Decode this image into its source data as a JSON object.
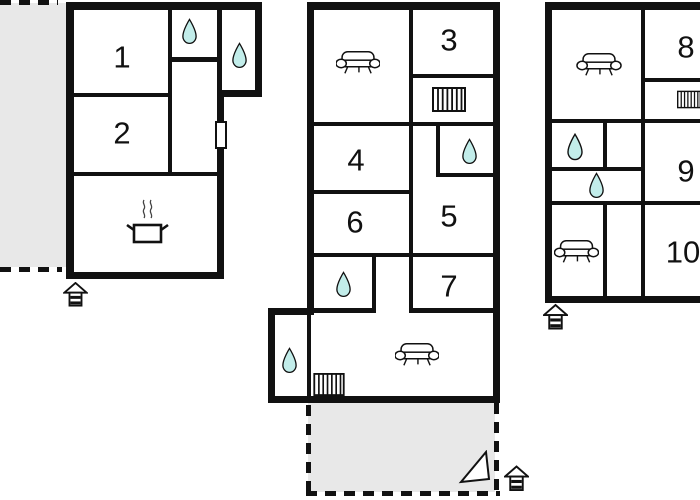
{
  "colors": {
    "wall": "#111111",
    "water_fill": "#c2edea",
    "terrace_fill": "#e8e8e8",
    "background": "#ffffff",
    "icon_stroke": "#111111"
  },
  "buildings": [
    {
      "id": "house-left",
      "rooms": [
        {
          "number": "1",
          "cx": 122,
          "cy": 57
        },
        {
          "number": "2",
          "cx": 122,
          "cy": 133
        }
      ],
      "icons": [
        {
          "name": "water-drop-icon",
          "x": 181,
          "y": 18,
          "w": 17,
          "h": 27
        },
        {
          "name": "water-drop-icon",
          "x": 231,
          "y": 42,
          "w": 17,
          "h": 27
        },
        {
          "name": "kitchen-stove-icon",
          "x": 124,
          "y": 197,
          "w": 46,
          "h": 50
        },
        {
          "name": "door-marker",
          "x": 215,
          "y": 121,
          "w": 12,
          "h": 28
        },
        {
          "name": "entrance-arrow-icon",
          "x": 63,
          "y": 282,
          "w": 25,
          "h": 25
        }
      ]
    },
    {
      "id": "house-middle",
      "rooms": [
        {
          "number": "3",
          "cx": 449,
          "cy": 40
        },
        {
          "number": "4",
          "cx": 356,
          "cy": 160
        },
        {
          "number": "5",
          "cx": 449,
          "cy": 216
        },
        {
          "number": "6",
          "cx": 355,
          "cy": 222
        },
        {
          "number": "7",
          "cx": 449,
          "cy": 286
        }
      ],
      "icons": [
        {
          "name": "sofa-icon",
          "x": 336,
          "y": 48,
          "w": 44,
          "h": 30
        },
        {
          "name": "radiator-icon",
          "x": 432,
          "y": 87,
          "w": 34,
          "h": 25
        },
        {
          "name": "water-drop-icon",
          "x": 461,
          "y": 138,
          "w": 17,
          "h": 27
        },
        {
          "name": "water-drop-icon",
          "x": 335,
          "y": 271,
          "w": 17,
          "h": 27
        },
        {
          "name": "water-drop-icon",
          "x": 281,
          "y": 347,
          "w": 17,
          "h": 27
        },
        {
          "name": "sofa-icon",
          "x": 395,
          "y": 340,
          "w": 44,
          "h": 30
        },
        {
          "name": "radiator-icon",
          "x": 312,
          "y": 373,
          "w": 34,
          "h": 23
        },
        {
          "name": "north-triangle-icon",
          "x": 458,
          "y": 450,
          "w": 35,
          "h": 35
        },
        {
          "name": "entrance-arrow-icon",
          "x": 504,
          "y": 465,
          "w": 25,
          "h": 27
        }
      ]
    },
    {
      "id": "house-right",
      "rooms": [
        {
          "number": "8",
          "cx": 686,
          "cy": 47
        },
        {
          "number": "9",
          "cx": 686,
          "cy": 171
        },
        {
          "number": "10",
          "cx": 683,
          "cy": 252
        }
      ],
      "icons": [
        {
          "name": "sofa-icon",
          "x": 576,
          "y": 50,
          "w": 46,
          "h": 30
        },
        {
          "name": "radiator-icon",
          "x": 677,
          "y": 87,
          "w": 24,
          "h": 25
        },
        {
          "name": "water-drop-icon",
          "x": 566,
          "y": 133,
          "w": 18,
          "h": 28
        },
        {
          "name": "water-drop-icon",
          "x": 588,
          "y": 172,
          "w": 17,
          "h": 27
        },
        {
          "name": "sofa-icon",
          "x": 554,
          "y": 237,
          "w": 45,
          "h": 30
        },
        {
          "name": "entrance-arrow-icon",
          "x": 543,
          "y": 303,
          "w": 25,
          "h": 28
        }
      ]
    }
  ]
}
